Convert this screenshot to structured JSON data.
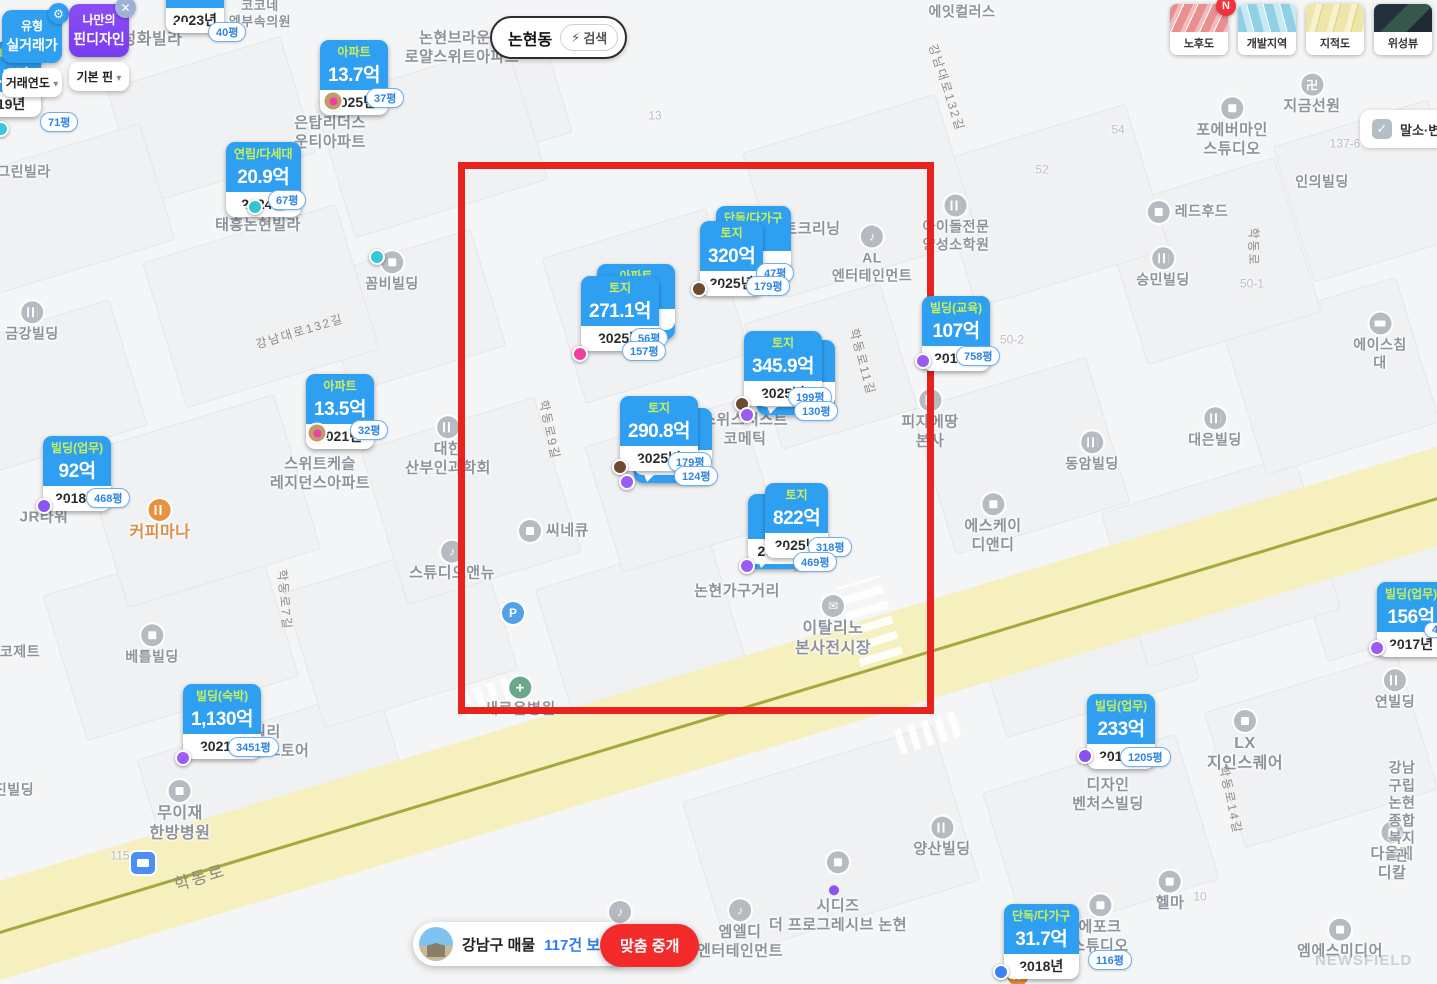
{
  "icons": {
    "gear": "⚙",
    "close": "✕",
    "caret": "▾",
    "bolt": "⚡",
    "check": "✓",
    "n": "N",
    "music": "♪",
    "mail": "✉",
    "plus": "+",
    "parking": "P",
    "temple": "卍"
  },
  "controls": {
    "type_panel": {
      "line1": "유형",
      "line2": "실거래가",
      "dropdown": "거래연도"
    },
    "pin_panel": {
      "line1": "나만의",
      "line2": "핀디자인",
      "dropdown": "기본 핀"
    },
    "search": {
      "value": "논현동",
      "action": "검색"
    },
    "map_types": [
      {
        "label": "노후도",
        "badge": "N"
      },
      {
        "label": "개발지역"
      },
      {
        "label": "지적도"
      },
      {
        "label": "위성뷰"
      }
    ],
    "filter_checkbox": {
      "label": "말소·변경",
      "checked": true
    },
    "listings_pill": {
      "region": "강남구 매물",
      "count_link": "117건 보기"
    },
    "match_button": {
      "label": "맞춤 중개"
    },
    "watermark": "NEWSFIELD"
  },
  "markers": [
    {
      "category": "연립/다세대",
      "price": "16.5억",
      "year": "2019년",
      "x": -34,
      "y": 42,
      "badges": [
        {
          "t": "71평",
          "x": 40,
          "y": 112
        }
      ],
      "pins": [
        {
          "x": 1,
          "y": 129,
          "c": "#35c8d8"
        }
      ]
    },
    {
      "category": "",
      "price": "",
      "year": "2023년",
      "x": 166,
      "y": -34,
      "badges": [
        {
          "t": "40평",
          "x": 208,
          "y": 22
        }
      ],
      "pins": []
    },
    {
      "category": "아파트",
      "price": "13.7억",
      "year": "2025년",
      "x": 320,
      "y": 40,
      "badges": [
        {
          "t": "37평",
          "x": 366,
          "y": 88
        }
      ],
      "pins": [
        {
          "x": 333,
          "y": 101,
          "c": "#f23ea0",
          "ring": "#c09b6b"
        }
      ]
    },
    {
      "category": "연립/다세대",
      "price": "20.9억",
      "year": "2024년",
      "x": 226,
      "y": 142,
      "badges": [
        {
          "t": "67평",
          "x": 268,
          "y": 190
        }
      ],
      "pins": [
        {
          "x": 255,
          "y": 207,
          "c": "#2fc8cf"
        }
      ]
    },
    {
      "category": "아파트",
      "price": "13.5억",
      "year": "2021년",
      "x": 306,
      "y": 374,
      "badges": [
        {
          "t": "32평",
          "x": 350,
          "y": 420
        }
      ],
      "pins": [
        {
          "x": 317,
          "y": 433,
          "c": "#f23ea0",
          "ring": "#c09b6b"
        }
      ]
    },
    {
      "category": "빌딩(업무)",
      "price": "92억",
      "year": "2018년",
      "x": 43,
      "y": 436,
      "badges": [
        {
          "t": "468평",
          "x": 86,
          "y": 488
        }
      ],
      "pins": [
        {
          "x": 44,
          "y": 506,
          "c": "#8a55f0"
        }
      ]
    },
    {
      "category": "빌딩(숙박)",
      "price": "1,130억",
      "year": "2021년",
      "x": 183,
      "y": 684,
      "badges": [
        {
          "t": "3451평",
          "x": 228,
          "y": 737
        }
      ],
      "pins": [
        {
          "x": 183,
          "y": 758,
          "c": "#9a5cf5"
        }
      ]
    },
    {
      "category": "토지",
      "price": "320억",
      "year": "2025년",
      "x": 700,
      "y": 221,
      "behind": {
        "category": "단독/다가구",
        "price": "",
        "year": "",
        "dx": 16,
        "dy": -15
      },
      "badges": [
        {
          "t": "47평",
          "x": 756,
          "y": 263
        },
        {
          "t": "179평",
          "x": 746,
          "y": 276
        }
      ],
      "pins": [
        {
          "x": 699,
          "y": 289,
          "c": "#6e4a2f"
        }
      ]
    },
    {
      "category": "토지",
      "price": "271.1억",
      "year": "2025년",
      "x": 581,
      "y": 276,
      "behind": {
        "category": "아파트",
        "price": "",
        "year": "",
        "dx": 16,
        "dy": -12
      },
      "badges": [
        {
          "t": "56평",
          "x": 630,
          "y": 328
        },
        {
          "t": "157평",
          "x": 622,
          "y": 341
        }
      ],
      "pins": [
        {
          "x": 580,
          "y": 354,
          "c": "#f23ea0"
        }
      ]
    },
    {
      "category": "토지",
      "price": "345.9억",
      "year": "2025년",
      "x": 744,
      "y": 331,
      "behind": {
        "category": "",
        "price": "",
        "year": "2021년",
        "dx": 13,
        "dy": 9
      },
      "badges": [
        {
          "t": "199평",
          "x": 788,
          "y": 387
        },
        {
          "t": "130평",
          "x": 794,
          "y": 401
        }
      ],
      "pins": [
        {
          "x": 742,
          "y": 404,
          "c": "#6e4a2f"
        },
        {
          "x": 747,
          "y": 415,
          "c": "#9a5cf5"
        }
      ]
    },
    {
      "category": "토지",
      "price": "290.8억",
      "year": "2025년",
      "x": 620,
      "y": 396,
      "behind": {
        "category": "",
        "price": "",
        "year": "2021년",
        "dx": 14,
        "dy": 12
      },
      "badges": [
        {
          "t": "179평",
          "x": 668,
          "y": 452
        },
        {
          "t": "124평",
          "x": 674,
          "y": 466
        }
      ],
      "pins": [
        {
          "x": 620,
          "y": 467,
          "c": "#6e4a2f"
        },
        {
          "x": 627,
          "y": 482,
          "c": "#9a5cf5"
        }
      ]
    },
    {
      "category": "토지",
      "price": "822억",
      "year": "2025년",
      "x": 765,
      "y": 483,
      "behind": {
        "category": "빌",
        "price": "52",
        "year": "2021년",
        "dx": -17,
        "dy": 11
      },
      "badges": [
        {
          "t": "318평",
          "x": 808,
          "y": 537
        },
        {
          "t": "469평",
          "x": 793,
          "y": 552
        }
      ],
      "pins": [
        {
          "x": 747,
          "y": 566,
          "c": "#9a5cf5"
        }
      ]
    },
    {
      "category": "빌딩(교육)",
      "price": "107억",
      "year": "2014년",
      "x": 922,
      "y": 296,
      "badges": [
        {
          "t": "758평",
          "x": 956,
          "y": 346
        }
      ],
      "pins": [
        {
          "x": 923,
          "y": 361,
          "c": "#9a5cf5"
        }
      ]
    },
    {
      "category": "빌딩(업무)",
      "price": "156억",
      "year": "2017년",
      "x": 1377,
      "y": 582,
      "badges": [
        {
          "t": "44",
          "x": 1424,
          "y": 622
        }
      ],
      "pins": [
        {
          "x": 1377,
          "y": 648,
          "c": "#9a5cf5"
        }
      ]
    },
    {
      "category": "빌딩(업무)",
      "price": "233억",
      "year": "2015년",
      "x": 1087,
      "y": 694,
      "badges": [
        {
          "t": "1205평",
          "x": 1120,
          "y": 747
        }
      ],
      "pins": [
        {
          "x": 1085,
          "y": 756,
          "c": "#8a50f0"
        }
      ]
    },
    {
      "category": "단독/다가구",
      "price": "31.7억",
      "year": "2018년",
      "x": 1004,
      "y": 904,
      "badges": [
        {
          "t": "116평",
          "x": 1088,
          "y": 950
        }
      ],
      "pins": [
        {
          "x": 1001,
          "y": 972,
          "c": "#3b82f6"
        }
      ]
    }
  ],
  "loose_pins": [
    {
      "x": 377,
      "y": 257,
      "c": "#35c8d8"
    }
  ],
  "map_labels": [
    {
      "t": "성화빌라",
      "x": 152,
      "y": 40,
      "s": 16
    },
    {
      "t": "코코네\n엠부속의원",
      "x": 260,
      "y": 14,
      "s": 13
    },
    {
      "t": "논현브라운스\n로얄스위트아파트",
      "x": 462,
      "y": 48,
      "s": 15
    },
    {
      "t": "에잇컬러스",
      "x": 962,
      "y": 12,
      "s": 14
    },
    {
      "t": "강남대로132길",
      "x": 946,
      "y": 88,
      "s": 12,
      "r": 72,
      "k": "road"
    },
    {
      "t": "은탑리더스\n운티아파트",
      "x": 330,
      "y": 133,
      "s": 15
    },
    {
      "t": "그린빌라",
      "x": 24,
      "y": 172,
      "s": 14
    },
    {
      "t": "태흥논현빌라",
      "x": 258,
      "y": 226,
      "s": 15
    },
    {
      "t": "13",
      "x": 655,
      "y": 116,
      "s": 12,
      "k": "num"
    },
    {
      "t": "54",
      "x": 1118,
      "y": 130,
      "s": 12,
      "k": "num"
    },
    {
      "t": "52",
      "x": 1042,
      "y": 170,
      "s": 12,
      "k": "num"
    },
    {
      "t": "137-6",
      "x": 1345,
      "y": 144,
      "s": 12,
      "k": "num"
    },
    {
      "t": "50-1",
      "x": 1252,
      "y": 284,
      "s": 12,
      "k": "num"
    },
    {
      "t": "50-2",
      "x": 1012,
      "y": 340,
      "s": 12,
      "k": "num"
    },
    {
      "t": "7",
      "x": 752,
      "y": 243,
      "s": 12,
      "k": "num"
    },
    {
      "t": "125",
      "x": 802,
      "y": 568,
      "s": 12,
      "k": "num"
    },
    {
      "t": "115",
      "x": 120,
      "y": 856,
      "s": 12,
      "k": "num"
    },
    {
      "t": "10",
      "x": 1200,
      "y": 897,
      "s": 12,
      "k": "num"
    },
    {
      "t": "포에버마인\n스튜디오",
      "x": 1232,
      "y": 128,
      "s": 15,
      "i": "dot"
    },
    {
      "t": "지금선원",
      "x": 1312,
      "y": 95,
      "s": 15,
      "i": "temple"
    },
    {
      "t": "인의빌딩",
      "x": 1322,
      "y": 182,
      "s": 14
    },
    {
      "t": "레드후드",
      "x": 1188,
      "y": 212,
      "s": 14,
      "i": "dot",
      "ipos": "l"
    },
    {
      "t": "승민빌딩",
      "x": 1163,
      "y": 268,
      "s": 14,
      "i": "building"
    },
    {
      "t": "아이돌전문\n양성소학원",
      "x": 956,
      "y": 224,
      "s": 14,
      "i": "building"
    },
    {
      "t": "트크리닝",
      "x": 812,
      "y": 230,
      "s": 15
    },
    {
      "t": "AL\n엔터테인먼트",
      "x": 872,
      "y": 255,
      "s": 14,
      "i": "music"
    },
    {
      "t": "강남대로132길",
      "x": 300,
      "y": 332,
      "s": 12,
      "r": -17,
      "k": "road"
    },
    {
      "t": "학동로",
      "x": 1253,
      "y": 247,
      "s": 12,
      "r": 90,
      "k": "road"
    },
    {
      "t": "금강빌딩",
      "x": 32,
      "y": 322,
      "s": 14,
      "i": "building"
    },
    {
      "t": "꼼비빌딩",
      "x": 392,
      "y": 272,
      "s": 14,
      "i": "dot"
    },
    {
      "t": "에이스침대",
      "x": 1380,
      "y": 342,
      "s": 14,
      "i": "bed"
    },
    {
      "t": "학동로11길",
      "x": 862,
      "y": 362,
      "s": 12,
      "r": 75,
      "k": "road"
    },
    {
      "t": "스위스서스트\n코메틱",
      "x": 745,
      "y": 430,
      "s": 15
    },
    {
      "t": "피자에땅\n본사",
      "x": 930,
      "y": 420,
      "s": 15,
      "i": "building"
    },
    {
      "t": "대은빌딩",
      "x": 1215,
      "y": 428,
      "s": 14,
      "i": "building"
    },
    {
      "t": "동암빌딩",
      "x": 1092,
      "y": 452,
      "s": 14,
      "i": "building"
    },
    {
      "t": "대한\n산부인과학회",
      "x": 448,
      "y": 447,
      "s": 15,
      "i": "building"
    },
    {
      "t": "스위트케슬\n레지던스아파트",
      "x": 320,
      "y": 474,
      "s": 15
    },
    {
      "t": "커피마나",
      "x": 160,
      "y": 521,
      "s": 16,
      "c": "#d98f4a",
      "i": "coffee"
    },
    {
      "t": "JR타워",
      "x": 44,
      "y": 518,
      "s": 15
    },
    {
      "t": "에스케이\n디앤디",
      "x": 993,
      "y": 524,
      "s": 15,
      "i": "dot"
    },
    {
      "t": "씨네큐",
      "x": 554,
      "y": 531,
      "s": 15,
      "i": "dot",
      "ipos": "l"
    },
    {
      "t": "스튜디오앤뉴",
      "x": 452,
      "y": 562,
      "s": 15,
      "i": "music"
    },
    {
      "t": "학동로9길",
      "x": 549,
      "y": 430,
      "s": 12,
      "r": 78,
      "k": "road"
    },
    {
      "t": "학동로7길",
      "x": 284,
      "y": 600,
      "s": 12,
      "r": 85,
      "k": "road"
    },
    {
      "t": "베틀빌딩",
      "x": 152,
      "y": 645,
      "s": 14,
      "i": "dot"
    },
    {
      "t": "코제트",
      "x": 20,
      "y": 652,
      "s": 14
    },
    {
      "t": "진빌딩",
      "x": 14,
      "y": 790,
      "s": 14
    },
    {
      "t": "새로운병원",
      "x": 520,
      "y": 698,
      "s": 15,
      "i": "cross"
    },
    {
      "t": "",
      "x": 513,
      "y": 613,
      "i": "parking"
    },
    {
      "t": "",
      "x": 143,
      "y": 863,
      "i": "bus"
    },
    {
      "t": "",
      "x": 620,
      "y": 912,
      "i": "music"
    },
    {
      "t": "논현가구거리",
      "x": 737,
      "y": 592,
      "s": 15
    },
    {
      "t": "이탈리노\n본사전시장",
      "x": 833,
      "y": 627,
      "s": 16,
      "i": "mail"
    },
    {
      "t": "연빌딩",
      "x": 1395,
      "y": 690,
      "s": 14,
      "i": "building"
    },
    {
      "t": "디사모빌리\n논현플래그십스토어",
      "x": 245,
      "y": 742,
      "s": 15
    },
    {
      "t": "무이재\n한방병원",
      "x": 180,
      "y": 812,
      "s": 16,
      "i": "dot"
    },
    {
      "t": "학동로",
      "x": 200,
      "y": 878,
      "s": 17,
      "r": -17,
      "k": "road"
    },
    {
      "t": "양산빌딩",
      "x": 942,
      "y": 838,
      "s": 15,
      "i": "building"
    },
    {
      "t": "시디즈\n더 프로그레시브 논현",
      "x": 838,
      "y": 893,
      "s": 15,
      "i": "chair",
      "pdot": true
    },
    {
      "t": "엠엘디\n엔터테인먼트",
      "x": 740,
      "y": 930,
      "s": 15,
      "i": "music"
    },
    {
      "t": "에포크\n스튜디오",
      "x": 1100,
      "y": 925,
      "s": 15,
      "i": "dot"
    },
    {
      "t": "헬마",
      "x": 1170,
      "y": 892,
      "s": 15,
      "i": "dot"
    },
    {
      "t": "엠에스미디어",
      "x": 1340,
      "y": 940,
      "s": 15,
      "i": "dot"
    },
    {
      "t": "다올메디칼",
      "x": 1392,
      "y": 852,
      "s": 15,
      "i": "dot"
    },
    {
      "t": "강남구립 논현\n종합복지관",
      "x": 1402,
      "y": 812,
      "s": 14
    },
    {
      "t": "LX\n지인스퀘어",
      "x": 1245,
      "y": 742,
      "s": 16,
      "i": "dot"
    },
    {
      "t": "디자인\n벤처스빌딩",
      "x": 1108,
      "y": 795,
      "s": 15
    },
    {
      "t": "학동로14길",
      "x": 1230,
      "y": 800,
      "s": 12,
      "r": 78,
      "k": "road"
    },
    {
      "t": "",
      "x": 1018,
      "y": 975,
      "i": "rest"
    }
  ]
}
